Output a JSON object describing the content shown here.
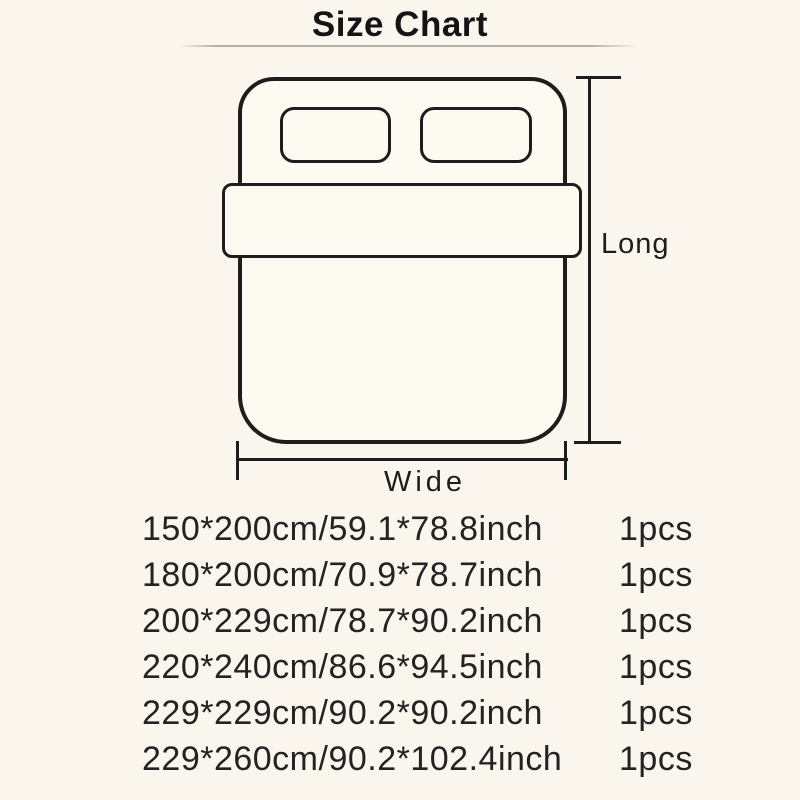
{
  "title": "Size Chart",
  "diagram": {
    "long_label": "Long",
    "wide_label": "Wide"
  },
  "size_list": {
    "rows": [
      {
        "size": "150*200cm/59.1*78.8inch",
        "qty": "1pcs"
      },
      {
        "size": "180*200cm/70.9*78.7inch",
        "qty": "1pcs"
      },
      {
        "size": "200*229cm/78.7*90.2inch",
        "qty": "1pcs"
      },
      {
        "size": "220*240cm/86.6*94.5inch",
        "qty": "1pcs"
      },
      {
        "size": "229*229cm/90.2*90.2inch",
        "qty": "1pcs"
      },
      {
        "size": "229*260cm/90.2*102.4inch",
        "qty": "1pcs"
      }
    ]
  },
  "colors": {
    "background": "#FBF6ED",
    "diagram_line": "#1D1D1D",
    "text": "#232323",
    "divider": "#78786F"
  }
}
